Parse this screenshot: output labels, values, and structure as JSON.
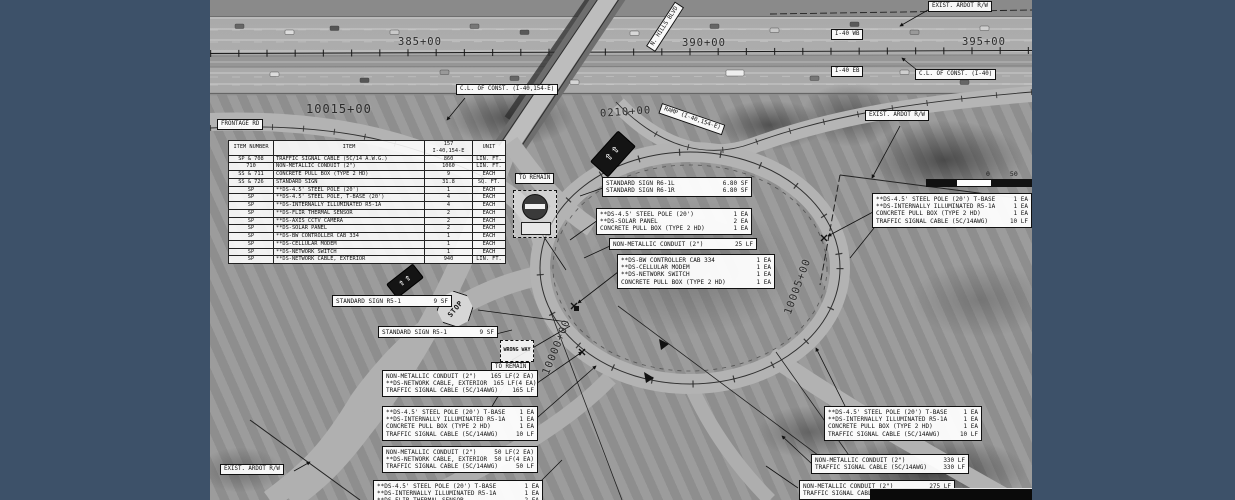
{
  "frame": {
    "border_color": "#3d5169"
  },
  "plan": {
    "stations": {
      "sta_385": "385+00",
      "sta_390": "390+00",
      "sta_395": "395+00",
      "sta_10015": "10015+00",
      "sta_0210": "0210+00",
      "sta_10005": "10005+00",
      "sta_10000": "10000+00"
    },
    "labels": {
      "exist_ardot_rw_top": "EXIST. ARDOT R/W",
      "exist_ardot_rw_right": "EXIST. ARDOT R/W",
      "exist_ardot_rw_bottom": "EXIST. ARDOT R/W",
      "i40_wb": "I-40 WB",
      "i40_eb": "I-40 EB",
      "cl_const_154e": "C.L. OF CONST. (I-40,154-E)",
      "cl_const_i40": "C.L. OF CONST. (I-40)",
      "frontage_rd": "FRONTAGE RD",
      "ramp_154e": "RAMP (I-40,154-E)",
      "n_hills_blvd": "N. HILLS BLVD",
      "to_remain_1": "TO REMAIN",
      "to_remain_2": "TO REMAIN"
    },
    "signs": {
      "stop": "STOP",
      "wrong_way": "WRONG WAY"
    },
    "scale_bar": {
      "zero": "0",
      "fifty": "50"
    },
    "quantity_table": {
      "headers": {
        "item_number": "ITEM NUMBER",
        "item": "ITEM",
        "job": "157",
        "route": "I-40,154-E",
        "unit": "UNIT"
      },
      "rows": [
        [
          "SP & 708",
          "TRAFFIC SIGNAL CABLE (5C/14 A.W.G.)",
          "860",
          "LIN. FT."
        ],
        [
          "710",
          "NON-METALLIC CONDUIT (2\")",
          "1060",
          "LIN. FT."
        ],
        [
          "SS & 711",
          "CONCRETE PULL BOX (TYPE 2 HD)",
          "9",
          "EACH"
        ],
        [
          "SS & 726",
          "STANDARD SIGN",
          "31.8",
          "SQ. FT."
        ],
        [
          "SP",
          "**DS-4.5' STEEL POLE (20')",
          "1",
          "EACH"
        ],
        [
          "SP",
          "**DS-4.5' STEEL POLE, T-BASE (20')",
          "4",
          "EACH"
        ],
        [
          "SP",
          "**DS-INTERNALLY ILLUMINATED R5-1A",
          "4",
          "EACH"
        ],
        [
          "SP",
          "**DS-FLIR THERMAL SENSOR",
          "2",
          "EACH"
        ],
        [
          "SP",
          "**DS-AXIS CCTV CAMERA",
          "2",
          "EACH"
        ],
        [
          "SP",
          "**DS-SOLAR PANEL",
          "2",
          "EACH"
        ],
        [
          "SP",
          "**DS-BW CONTROLLER CAB 334",
          "1",
          "EACH"
        ],
        [
          "SP",
          "**DS-CELLULAR MODEM",
          "1",
          "EACH"
        ],
        [
          "SP",
          "**DS-NETWORK SWITCH",
          "1",
          "EACH"
        ],
        [
          "SP",
          "**DS-NETWORK CABLE, EXTERIOR",
          "940",
          "LIN. FT."
        ]
      ]
    },
    "callouts": {
      "std_sign_r6": {
        "lines": [
          [
            "STANDARD SIGN R6-1L",
            "6.80 SF"
          ],
          [
            "STANDARD SIGN R6-1R",
            "6.80 SF"
          ]
        ]
      },
      "pole_solar": {
        "lines": [
          [
            "**DS-4.5' STEEL POLE (20')",
            "1 EA"
          ],
          [
            "**DS-SOLAR PANEL",
            "2 EA"
          ],
          [
            "CONCRETE PULL BOX (TYPE 2 HD)",
            "1 EA"
          ]
        ]
      },
      "conduit_25": {
        "lines": [
          [
            "NON-METALLIC CONDUIT (2\")",
            "25 LF"
          ]
        ]
      },
      "controller": {
        "lines": [
          [
            "**DS-BW CONTROLLER CAB 334",
            "1 EA"
          ],
          [
            "**DS-CELLULAR MODEM",
            "1 EA"
          ],
          [
            "**DS-NETWORK SWITCH",
            "1 EA"
          ],
          [
            "CONCRETE PULL BOX (TYPE 2 HD)",
            "1 EA"
          ]
        ]
      },
      "pole_east": {
        "lines": [
          [
            "**DS-4.5' STEEL POLE (20') T-BASE",
            "1 EA"
          ],
          [
            "**DS-INTERNALLY ILLUMINATED R5-1A",
            "1 EA"
          ],
          [
            "CONCRETE PULL BOX (TYPE 2 HD)",
            "1 EA"
          ],
          [
            "TRAFFIC SIGNAL CABLE (5C/14AWG)",
            "10 LF"
          ]
        ]
      },
      "std_r5_a": {
        "lines": [
          [
            "STANDARD SIGN R5-1",
            "9 SF"
          ]
        ]
      },
      "std_r5_b": {
        "lines": [
          [
            "STANDARD SIGN R5-1",
            "9 SF"
          ]
        ]
      },
      "conduit_165": {
        "lines": [
          [
            "NON-METALLIC CONDUIT (2\")",
            "165 LF(2 EA)"
          ],
          [
            "**DS-NETWORK CABLE, EXTERIOR",
            "165 LF(4 EA)"
          ],
          [
            "TRAFFIC SIGNAL CABLE (5C/14AWG)",
            "165 LF"
          ]
        ]
      },
      "pole_sw": {
        "lines": [
          [
            "**DS-4.5' STEEL POLE (20') T-BASE",
            "1 EA"
          ],
          [
            "**DS-INTERNALLY ILLUMINATED R5-1A",
            "1 EA"
          ],
          [
            "CONCRETE PULL BOX (TYPE 2 HD)",
            "1 EA"
          ],
          [
            "TRAFFIC SIGNAL CABLE (5C/14AWG)",
            "10 LF"
          ]
        ]
      },
      "conduit_50": {
        "lines": [
          [
            "NON-METALLIC CONDUIT (2\")",
            "50 LF(2 EA)"
          ],
          [
            "**DS-NETWORK CABLE, EXTERIOR",
            "50 LF(4 EA)"
          ],
          [
            "TRAFFIC SIGNAL CABLE (5C/14AWG)",
            "50 LF"
          ]
        ]
      },
      "pole_flir": {
        "lines": [
          [
            "**DS-4.5' STEEL POLE (20') T-BASE",
            "1 EA"
          ],
          [
            "**DS-INTERNALLY ILLUMINATED R5-1A",
            "1 EA"
          ],
          [
            "**DS-FLIR THERMAL SENSOR",
            "2 EA"
          ]
        ]
      },
      "pole_se": {
        "lines": [
          [
            "**DS-4.5' STEEL POLE (20') T-BASE",
            "1 EA"
          ],
          [
            "**DS-INTERNALLY ILLUMINATED R5-1A",
            "1 EA"
          ],
          [
            "CONCRETE PULL BOX (TYPE 2 HD)",
            "1 EA"
          ],
          [
            "TRAFFIC SIGNAL CABLE (5C/14AWG)",
            "10 LF"
          ]
        ]
      },
      "conduit_330": {
        "lines": [
          [
            "NON-METALLIC CONDUIT (2\")",
            "330 LF"
          ],
          [
            "TRAFFIC SIGNAL CABLE (5C/14AWG)",
            "330 LF"
          ]
        ]
      },
      "conduit_275": {
        "lines": [
          [
            "NON-METALLIC CONDUIT (2\")",
            "275 LF"
          ],
          [
            "TRAFFIC SIGNAL CABLE (5C/14AWG)",
            "275 LF"
          ]
        ]
      }
    }
  }
}
